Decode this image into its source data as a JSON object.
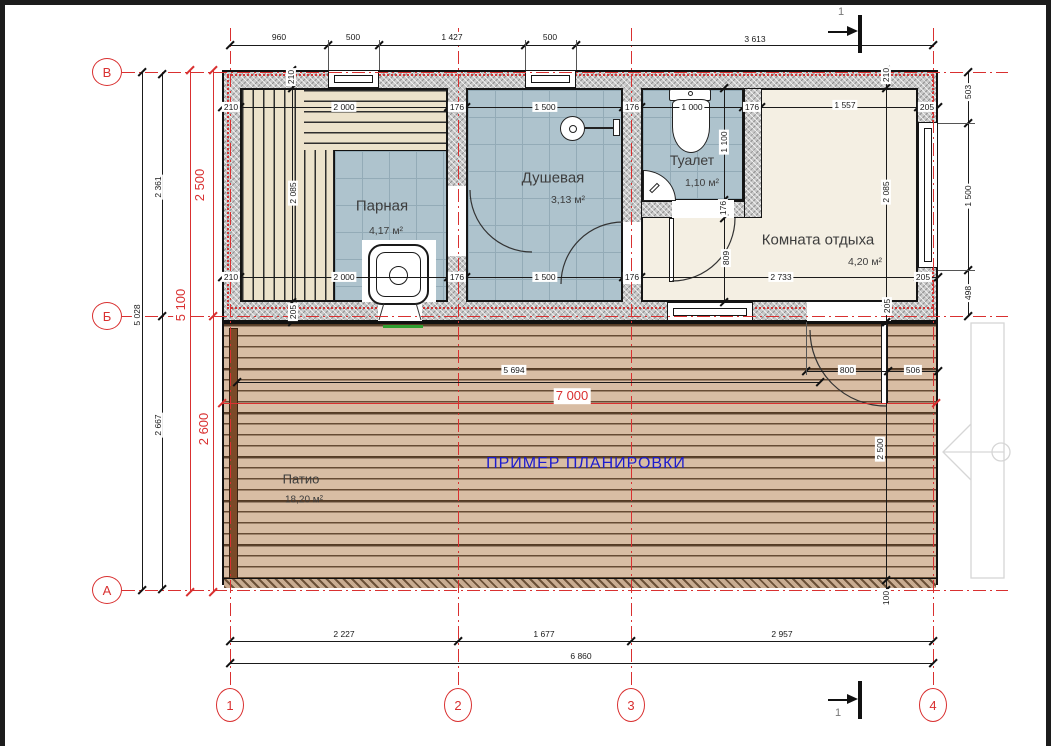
{
  "drawing": {
    "note": {
      "text": "ПРИМЕР ПЛАНИРОВКИ",
      "color": "#1c1ccf"
    },
    "rooms": [
      {
        "name": "Парная",
        "area": "4,17 м²"
      },
      {
        "name": "Душевая",
        "area": "3,13 м²"
      },
      {
        "name": "Туалет",
        "area": "1,10 м²"
      },
      {
        "name": "Комната отдыха",
        "area": "4,20 м²"
      },
      {
        "name": "Патио",
        "area": "18,20 м²"
      }
    ],
    "axes": {
      "rows": [
        {
          "label": "В",
          "cx": 107,
          "cy": 72
        },
        {
          "label": "Б",
          "cx": 107,
          "cy": 316
        },
        {
          "label": "А",
          "cx": 107,
          "cy": 590
        }
      ],
      "cols": [
        {
          "label": "1",
          "cx": 230,
          "cy": 705
        },
        {
          "label": "2",
          "cx": 458,
          "cy": 705
        },
        {
          "label": "3",
          "cx": 631,
          "cy": 705
        },
        {
          "label": "4",
          "cx": 933,
          "cy": 705
        }
      ]
    },
    "section_marks": [
      {
        "label": "1",
        "x": 838,
        "y": 6
      },
      {
        "label": "1",
        "x": 835,
        "y": 707
      }
    ],
    "colors": {
      "grid": "#d93030",
      "tile": "#aec3cd",
      "deck": "#d8bda4",
      "bench": "#ece2cb",
      "wall": "#c8c8c8",
      "floor": "#f4efe3",
      "note_blue": "#1c1ccf",
      "stove_green": "#2f9e2f"
    },
    "dimensions": [
      {
        "t": "960",
        "x": 279,
        "y": 37
      },
      {
        "t": "500",
        "x": 353,
        "y": 37
      },
      {
        "t": "1 427",
        "x": 452,
        "y": 37
      },
      {
        "t": "500",
        "x": 550,
        "y": 37
      },
      {
        "t": "3 613",
        "x": 755,
        "y": 39
      },
      {
        "t": "210",
        "x": 231,
        "y": 107
      },
      {
        "t": "2 000",
        "x": 344,
        "y": 107
      },
      {
        "t": "176",
        "x": 457,
        "y": 107
      },
      {
        "t": "1 500",
        "x": 545,
        "y": 107
      },
      {
        "t": "176",
        "x": 632,
        "y": 107
      },
      {
        "t": "1 000",
        "x": 692,
        "y": 107
      },
      {
        "t": "176",
        "x": 752,
        "y": 107
      },
      {
        "t": "1 557",
        "x": 845,
        "y": 105
      },
      {
        "t": "205",
        "x": 927,
        "y": 107
      },
      {
        "t": "210",
        "x": 231,
        "y": 277
      },
      {
        "t": "2 000",
        "x": 344,
        "y": 277
      },
      {
        "t": "176",
        "x": 457,
        "y": 277
      },
      {
        "t": "1 500",
        "x": 545,
        "y": 277
      },
      {
        "t": "176",
        "x": 632,
        "y": 277
      },
      {
        "t": "2 733",
        "x": 781,
        "y": 277
      },
      {
        "t": "205",
        "x": 923,
        "y": 277
      },
      {
        "t": "5 694",
        "x": 514,
        "y": 370
      },
      {
        "t": "800",
        "x": 847,
        "y": 370
      },
      {
        "t": "506",
        "x": 913,
        "y": 370
      },
      {
        "t": "2 227",
        "x": 344,
        "y": 634
      },
      {
        "t": "1 677",
        "x": 544,
        "y": 634
      },
      {
        "t": "2 957",
        "x": 782,
        "y": 634
      },
      {
        "t": "6 860",
        "x": 581,
        "y": 656
      },
      {
        "t": "210",
        "x": 291,
        "y": 77,
        "r": 1
      },
      {
        "t": "210",
        "x": 886,
        "y": 75,
        "r": 1
      },
      {
        "t": "2 085",
        "x": 293,
        "y": 193,
        "r": 1
      },
      {
        "t": "2 085",
        "x": 886,
        "y": 192,
        "r": 1
      },
      {
        "t": "205",
        "x": 293,
        "y": 312,
        "r": 1
      },
      {
        "t": "205",
        "x": 887,
        "y": 306,
        "r": 1
      },
      {
        "t": "1 100",
        "x": 724,
        "y": 142,
        "r": 1
      },
      {
        "t": "176",
        "x": 723,
        "y": 208,
        "r": 1
      },
      {
        "t": "809",
        "x": 726,
        "y": 258,
        "r": 1
      },
      {
        "t": "503",
        "x": 968,
        "y": 92,
        "r": 1
      },
      {
        "t": "1 500",
        "x": 968,
        "y": 196,
        "r": 1
      },
      {
        "t": "498",
        "x": 968,
        "y": 293,
        "r": 1
      },
      {
        "t": "100",
        "x": 886,
        "y": 598,
        "r": 1
      },
      {
        "t": "2 500",
        "x": 880,
        "y": 449,
        "r": 1
      },
      {
        "t": "2 361",
        "x": 158,
        "y": 187,
        "r": 1
      },
      {
        "t": "5 028",
        "x": 137,
        "y": 315,
        "r": 1
      },
      {
        "t": "2 667",
        "x": 158,
        "y": 425,
        "r": 1
      },
      {
        "t": "2 500",
        "x": 200,
        "y": 185,
        "r": 1,
        "s": "red"
      },
      {
        "t": "5 100",
        "x": 181,
        "y": 305,
        "r": 1,
        "s": "red"
      },
      {
        "t": "2 600",
        "x": 204,
        "y": 429,
        "r": 1,
        "s": "red"
      },
      {
        "t": "7 000",
        "x": 572,
        "y": 396,
        "s": "red"
      }
    ]
  }
}
